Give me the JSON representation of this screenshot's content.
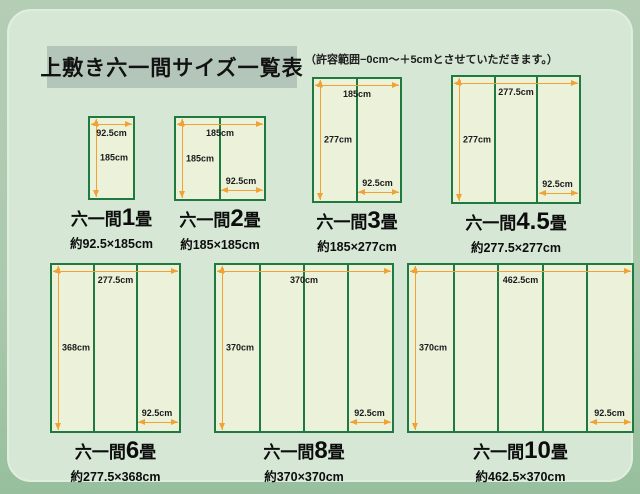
{
  "header": {
    "title": "上敷き六一間サイズ一覧表",
    "note": "（許容範囲−0cm～＋5cmとさせていただきます。）"
  },
  "colors": {
    "panel_background": "#d6e7d5",
    "outer_background": "#a3c5a7",
    "title_box_background": "#b3c6b9",
    "mat_fill": "#ecf2da",
    "mat_border": "#1e7a3e",
    "dimension_arrow": "#f0a233"
  },
  "diagrams": [
    {
      "id": "1jo",
      "caption_prefix": "六一間",
      "caption_size": "1",
      "caption_suffix": "畳",
      "subcaption": "約92.5×185cm",
      "width_label": "92.5cm",
      "height_label": "185cm",
      "column_label": null,
      "columns": 1
    },
    {
      "id": "2jo",
      "caption_prefix": "六一間",
      "caption_size": "2",
      "caption_suffix": "畳",
      "subcaption": "約185×185cm",
      "width_label": "185cm",
      "height_label": "185cm",
      "column_label": "92.5cm",
      "columns": 2
    },
    {
      "id": "3jo",
      "caption_prefix": "六一間",
      "caption_size": "3",
      "caption_suffix": "畳",
      "subcaption": "約185×277cm",
      "width_label": "185cm",
      "height_label": "277cm",
      "column_label": "92.5cm",
      "columns": 2
    },
    {
      "id": "4-5jo",
      "caption_prefix": "六一間",
      "caption_size": "4.5",
      "caption_suffix": "畳",
      "subcaption": "約277.5×277cm",
      "width_label": "277.5cm",
      "height_label": "277cm",
      "column_label": "92.5cm",
      "columns": 3
    },
    {
      "id": "6jo",
      "caption_prefix": "六一間",
      "caption_size": "6",
      "caption_suffix": "畳",
      "subcaption": "約277.5×368cm",
      "width_label": "277.5cm",
      "height_label": "368cm",
      "column_label": "92.5cm",
      "columns": 3
    },
    {
      "id": "8jo",
      "caption_prefix": "六一間",
      "caption_size": "8",
      "caption_suffix": "畳",
      "subcaption": "約370×370cm",
      "width_label": "370cm",
      "height_label": "370cm",
      "column_label": "92.5cm",
      "columns": 4
    },
    {
      "id": "10jo",
      "caption_prefix": "六一間",
      "caption_size": "10",
      "caption_suffix": "畳",
      "subcaption": "約462.5×370cm",
      "width_label": "462.5cm",
      "height_label": "370cm",
      "column_label": "92.5cm",
      "columns": 5
    }
  ]
}
